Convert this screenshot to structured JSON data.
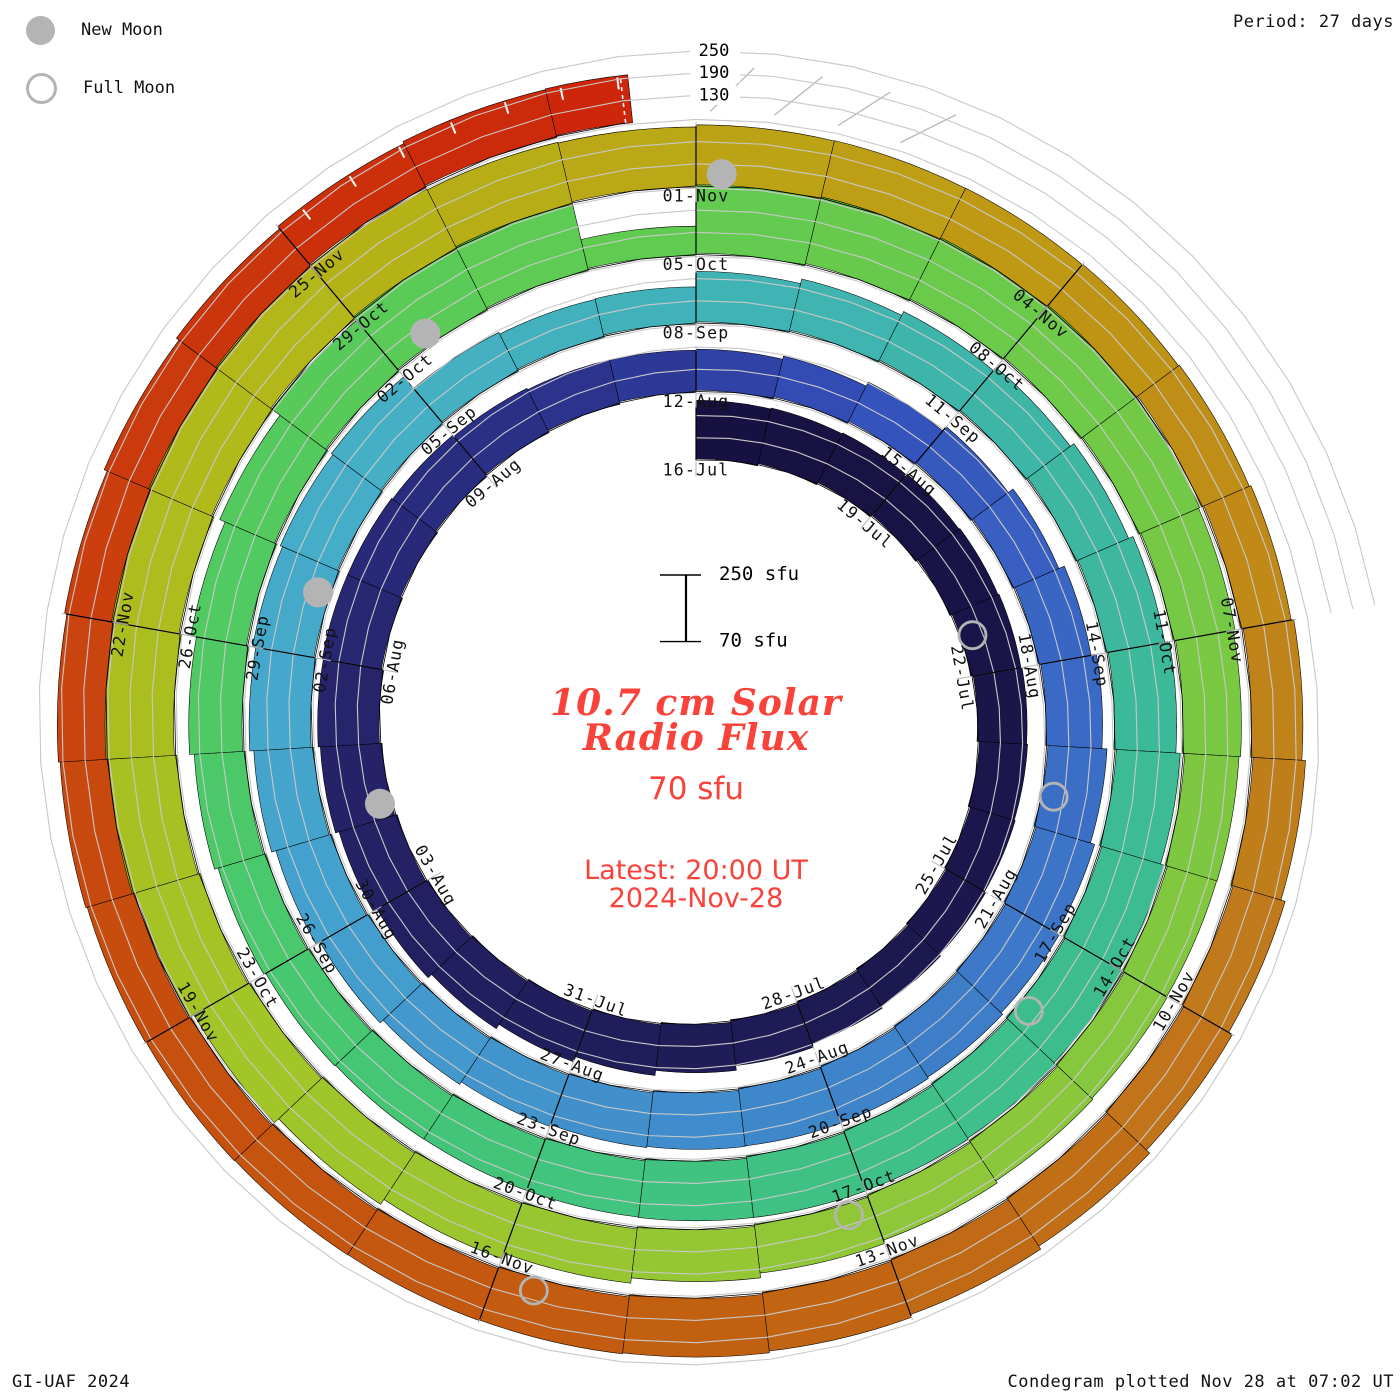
{
  "legend": {
    "new_moon_label": "New Moon",
    "full_moon_label": "Full Moon"
  },
  "annotations": {
    "period": "Period: 27 days",
    "credit_left": "GI-UAF 2024",
    "credit_right": "Condegram plotted Nov 28 at 07:02 UT"
  },
  "center": {
    "title_line1": "10.7 cm Solar",
    "title_line2": "Radio Flux",
    "flux_now": "70 sfu",
    "latest_line1": "Latest: 20:00 UT",
    "latest_line2": "2024-Nov-28"
  },
  "scalebar": {
    "top_label": "250 sfu",
    "bottom_label": "70 sfu",
    "top_value": 250,
    "bottom_value": 70,
    "x": 686,
    "y_top": 575
  },
  "axis": {
    "tick_labels": [
      "250",
      "190",
      "130"
    ],
    "tick_values": [
      250,
      190,
      130
    ]
  },
  "chart_data": {
    "type": "spiral_bar_condegram",
    "title": "10.7 cm Solar Radio Flux",
    "start_date": "2024-07-16",
    "end_date": "2024-11-28",
    "period_days": 27,
    "baseline_sfu": 70,
    "gridline_sfu": [
      130,
      190,
      250
    ],
    "date_labels": [
      "16-Jul",
      "19-Jul",
      "22-Jul",
      "25-Jul",
      "28-Jul",
      "31-Jul",
      "03-Aug",
      "06-Aug",
      "09-Aug",
      "12-Aug",
      "15-Aug",
      "18-Aug",
      "21-Aug",
      "24-Aug",
      "27-Aug",
      "30-Aug",
      "02-Sep",
      "05-Sep",
      "08-Sep",
      "11-Sep",
      "14-Sep",
      "17-Sep",
      "20-Sep",
      "23-Sep",
      "26-Sep",
      "29-Sep",
      "02-Oct",
      "05-Oct",
      "08-Oct",
      "11-Oct",
      "14-Oct",
      "17-Oct",
      "20-Oct",
      "23-Oct",
      "26-Oct",
      "29-Oct",
      "01-Nov",
      "04-Nov",
      "07-Nov",
      "10-Nov",
      "13-Nov",
      "16-Nov",
      "19-Nov",
      "22-Nov",
      "25-Nov"
    ],
    "flux_sfu": [
      228,
      224,
      220,
      216,
      212,
      208,
      204,
      200,
      196,
      193,
      191,
      191,
      195,
      201,
      208,
      216,
      223,
      229,
      234,
      237,
      236,
      232,
      225,
      215,
      204,
      193,
      185,
      181,
      183,
      189,
      197,
      206,
      215,
      223,
      230,
      235,
      237,
      236,
      233,
      228,
      223,
      219,
      217,
      218,
      222,
      227,
      232,
      236,
      238,
      238,
      236,
      188,
      176,
      171,
      206,
      212,
      217,
      221,
      226,
      232,
      238,
      243,
      247,
      249,
      248,
      244,
      238,
      231,
      223,
      216,
      210,
      206,
      205,
      208,
      214,
      222,
      231,
      250,
      283,
      290,
      150,
      268,
      272,
      268,
      260,
      250,
      240,
      228,
      217,
      209,
      204,
      201,
      201,
      204,
      210,
      218,
      227,
      236,
      245,
      252,
      258,
      263,
      265,
      264,
      259,
      251,
      242,
      233,
      232,
      226,
      220,
      215,
      211,
      209,
      209,
      212,
      217,
      222,
      227,
      230,
      231,
      229,
      225,
      220,
      214,
      209,
      204,
      201,
      199,
      199,
      201,
      203,
      204,
      203,
      200,
      196
    ],
    "colormap": [
      [
        0,
        "#16113f"
      ],
      [
        10,
        "#1c1850"
      ],
      [
        20,
        "#252268"
      ],
      [
        26,
        "#2c3490"
      ],
      [
        29,
        "#3450bb"
      ],
      [
        33,
        "#3a68c4"
      ],
      [
        39,
        "#3f85cb"
      ],
      [
        45,
        "#44a0cd"
      ],
      [
        50,
        "#46aec8"
      ],
      [
        55,
        "#3fb3b2"
      ],
      [
        61,
        "#3cba97"
      ],
      [
        68,
        "#40c37f"
      ],
      [
        74,
        "#4cc966"
      ],
      [
        80,
        "#5ecb52"
      ],
      [
        86,
        "#73c945"
      ],
      [
        92,
        "#8cc73a"
      ],
      [
        98,
        "#a0c628"
      ],
      [
        104,
        "#b2b91a"
      ],
      [
        110,
        "#bf9c13"
      ],
      [
        116,
        "#c07b1c"
      ],
      [
        122,
        "#c25e10"
      ],
      [
        128,
        "#c9470e"
      ],
      [
        133,
        "#cc2d0b"
      ],
      [
        135,
        "#cd240a"
      ]
    ],
    "moons": {
      "marker_color": "#b4b4b4",
      "new_moon_days": [
        19.2,
        48.7,
        78.4,
        108.2
      ],
      "full_moon_days": [
        5.4,
        34.6,
        63.8,
        93.2,
        122.7
      ]
    },
    "geometry": {
      "cx": 696,
      "cy": 725,
      "r0": 265,
      "spacing_per_rotation": 68.5,
      "px_per_sfu": 0.37,
      "days_per_rotation": 27,
      "end_day": 134.55,
      "gridline_extent_day": 141,
      "label_inset_px": 10
    }
  }
}
